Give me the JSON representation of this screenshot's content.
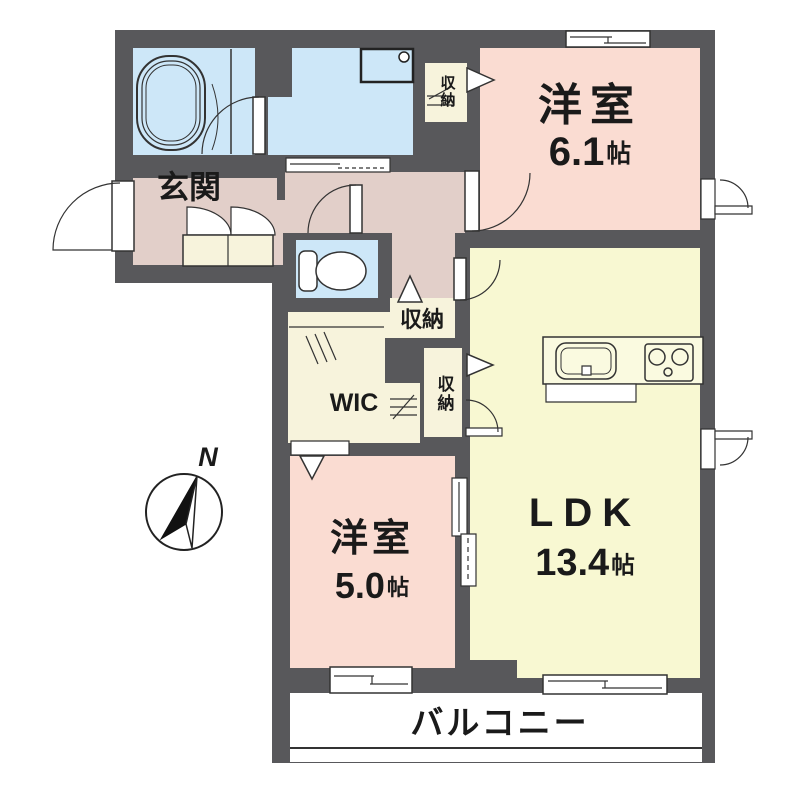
{
  "plan": {
    "entrance": {
      "label": "玄関"
    },
    "bedroom_a": {
      "label": "洋室",
      "size_value": "6.1",
      "size_unit": "帖"
    },
    "ldk": {
      "label": "LDK",
      "size_value": "13.4",
      "size_unit": "帖"
    },
    "bedroom_b": {
      "label": "洋室",
      "size_value": "5.0",
      "size_unit": "帖"
    },
    "wic": {
      "label": "WIC"
    },
    "closet_upper": {
      "label": "収納"
    },
    "closet_hall": {
      "label": "収納"
    },
    "closet_ldk": {
      "label": "収納"
    },
    "balcony": {
      "label": "バルコニー"
    },
    "compass": {
      "label": "N"
    }
  },
  "colors": {
    "wall": "#58585b",
    "line": "#333333",
    "water": "#cde7f8",
    "bedroom": "#fadcd2",
    "entrance": "#e2cfc9",
    "ldk": "#f8f8d2",
    "closet": "#f7f3dc",
    "balcony": "#ffffff"
  }
}
